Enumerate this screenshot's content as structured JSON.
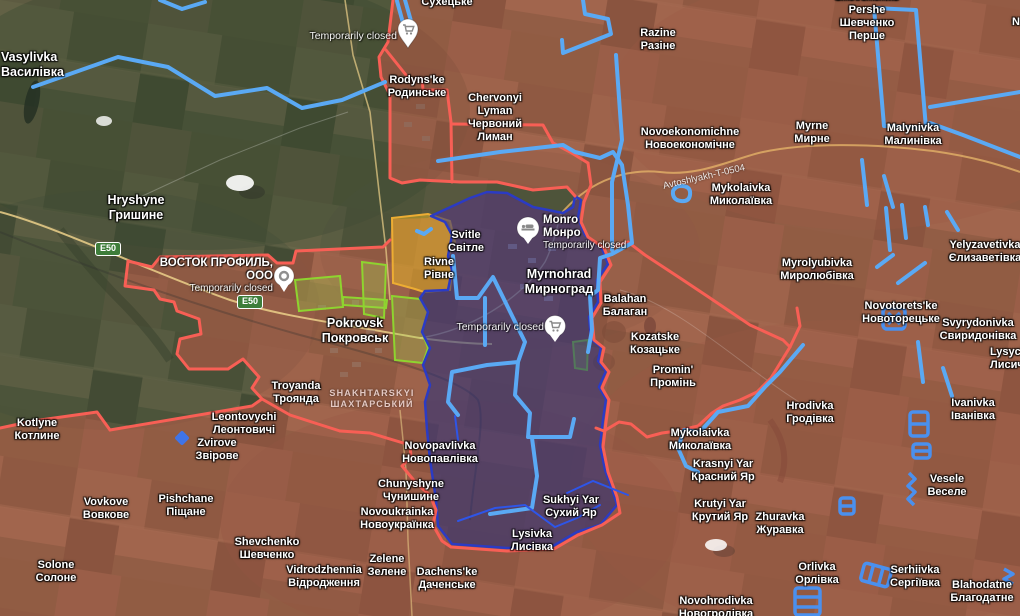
{
  "map_title": "DeepState-style frontline map, Pokrovsk–Myrnohrad area",
  "colors": {
    "frontline_red": "#f85f55",
    "occupied_tint": "#d04f43",
    "pocket_blue_fill": "#222d7e",
    "pocket_blue_stroke": "#2b3bc4",
    "contested_yellow": "#edad33",
    "liberated_green": "#8ed42f",
    "fortification_blue": "#5aa9f4",
    "defense_line_blue": "#2e55e8",
    "road_badge_green": "#3e7d3a"
  },
  "road_badges": [
    {
      "label": "E50"
    },
    {
      "label": "E50"
    }
  ],
  "road_label": "Avtoshlyakh-T-0504",
  "district": {
    "line1": "SHAKHTARSKYI",
    "line2": "ШАХТАРСЬКИЙ"
  },
  "pois": [
    {
      "name": "ВОСТОК ПРОФИЛЬ, ООО",
      "status": "Temporarily closed"
    },
    {
      "name": "Monro",
      "name_uk": "Монро",
      "status": "Temporarily closed"
    },
    {
      "status": "Temporarily closed"
    },
    {
      "status": "Temporarily closed"
    }
  ],
  "places": [
    {
      "en": "Vasylivka",
      "uk": "Василівка"
    },
    {
      "en": "Hryshyne",
      "uk": "Гришине"
    },
    {
      "en": "",
      "uk": "Сухецьке"
    },
    {
      "en": "Rodyns'ke",
      "uk": "Родинське"
    },
    {
      "en": "Chervonyi Lyman",
      "uk": "Червоний Лиман"
    },
    {
      "en": "Razine",
      "uk": "Разіне"
    },
    {
      "en": "Novoekonomichne",
      "uk": "Новоекономічне"
    },
    {
      "en": "Myrne",
      "uk": "Мирне"
    },
    {
      "en": "Malynivka",
      "uk": "Малинівка"
    },
    {
      "en": "Mykolaivka",
      "uk": "Миколаївка"
    },
    {
      "en": "Shevchenko Pershe",
      "uk": "Шевченко Перше"
    },
    {
      "en": "Yelyzavetivka",
      "uk": "Єлизаветівка"
    },
    {
      "en": "Myrolyubivka",
      "uk": "Миролюбівка"
    },
    {
      "en": "Novotorets'ke",
      "uk": "Новоторецьке"
    },
    {
      "en": "Svyrydonivka",
      "uk": "Свиридонівка"
    },
    {
      "en": "Lysych",
      "uk": "Лисич"
    },
    {
      "en": "Ivanivka",
      "uk": "Іванівка"
    },
    {
      "en": "Hrodivka",
      "uk": "Гродівка"
    },
    {
      "en": "Balahan",
      "uk": "Балаган"
    },
    {
      "en": "Kozatske",
      "uk": "Козацьке"
    },
    {
      "en": "Promin'",
      "uk": "Промінь"
    },
    {
      "en": "Mykolaivka",
      "uk": "Миколаївка"
    },
    {
      "en": "Krasnyi Yar",
      "uk": "Красний Яр"
    },
    {
      "en": "Krutyi Yar",
      "uk": "Крутий Яр"
    },
    {
      "en": "Zhuravka",
      "uk": "Журавка"
    },
    {
      "en": "Vesele",
      "uk": "Веселе"
    },
    {
      "en": "Orlivka",
      "uk": "Орлівка"
    },
    {
      "en": "Serhiivka",
      "uk": "Сергіївка"
    },
    {
      "en": "Blahodatne",
      "uk": "Благодатне"
    },
    {
      "en": "Novohrodivka",
      "uk": "Новогродівка"
    },
    {
      "en": "Kotlyne",
      "uk": "Котлине"
    },
    {
      "en": "Leontovychi",
      "uk": "Леонтовичі"
    },
    {
      "en": "Zvirove",
      "uk": "Звірове"
    },
    {
      "en": "Vovkove",
      "uk": "Вовкове"
    },
    {
      "en": "Pishchane",
      "uk": "Піщане"
    },
    {
      "en": "Shevchenko",
      "uk": "Шевченко"
    },
    {
      "en": "Solone",
      "uk": "Солоне"
    },
    {
      "en": "Vidrodzhennia",
      "uk": "Відродження"
    },
    {
      "en": "Zelene",
      "uk": "Зелене"
    },
    {
      "en": "Dachens'ke",
      "uk": "Даченське"
    },
    {
      "en": "Novoukrainka",
      "uk": "Новоукраїнка"
    },
    {
      "en": "Chunyshyne",
      "uk": "Чунишине"
    },
    {
      "en": "Novopavlivka",
      "uk": "Новопавлівка"
    },
    {
      "en": "Sukhyi Yar",
      "uk": "Сухий Яр"
    },
    {
      "en": "Lysivka",
      "uk": "Лисівка"
    },
    {
      "en": "Svitle",
      "uk": "Світле"
    },
    {
      "en": "Rivne",
      "uk": "Рівне"
    },
    {
      "en": "Myrnohrad",
      "uk": "Мирноград"
    },
    {
      "en": "Pokrovsk",
      "uk": "Покровськ"
    },
    {
      "en": "Troyanda",
      "uk": "Троянда"
    },
    {
      "en": "N",
      "uk": ""
    }
  ]
}
